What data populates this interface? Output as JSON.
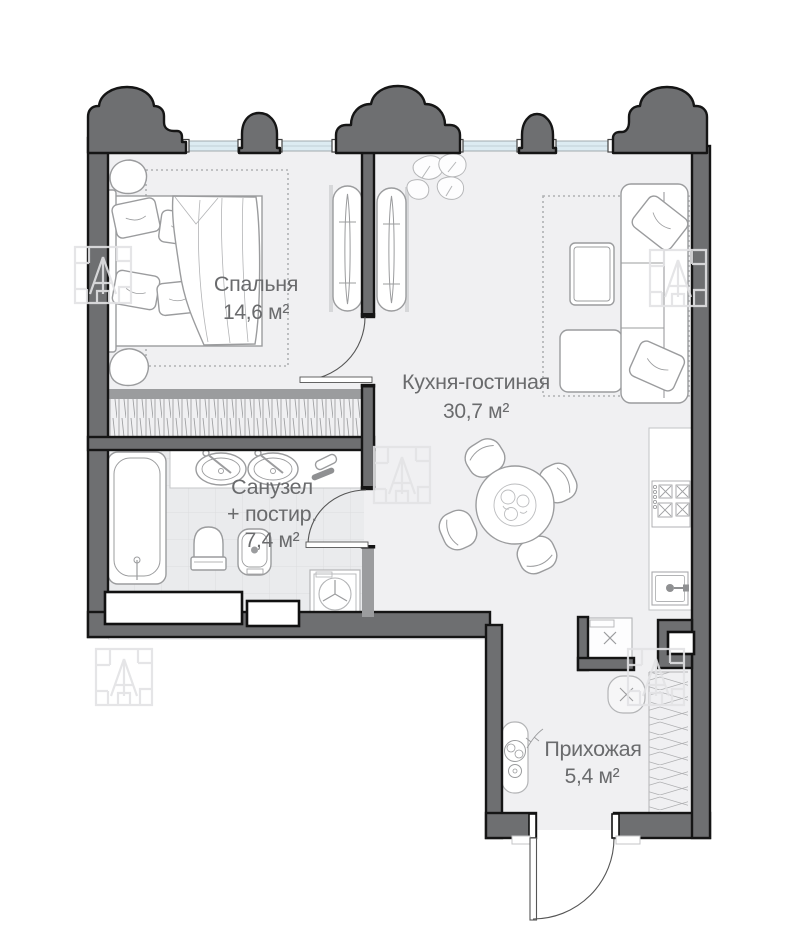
{
  "plan_title": "Apartment floor plan",
  "rooms": {
    "bedroom": {
      "name": "Спальня",
      "area": "14,6 м²"
    },
    "living": {
      "name": "Кухня-гостиная",
      "area": "30,7 м²"
    },
    "bathroom": {
      "name_line1": "Санузел",
      "name_line2": "+ постир.",
      "area": "7,4 м²"
    },
    "hallway": {
      "name": "Прихожая",
      "area": "5,4 м²"
    }
  },
  "colors": {
    "wall": "#6e6f71",
    "wall_outline": "#151515",
    "window_glass": "#dcebf2",
    "floor": "#f0f0f2",
    "bathroom_tile": "#eaebed",
    "furniture_line": "#9b9c9e",
    "label_text": "#6a6b6d",
    "watermark": "#e2e3e5"
  },
  "icons": {
    "washer_drum": "Y-spoke drum symbol",
    "appliance_mark": "×",
    "pouf_mark": "×",
    "developer_logo": "square block logo watermark"
  }
}
